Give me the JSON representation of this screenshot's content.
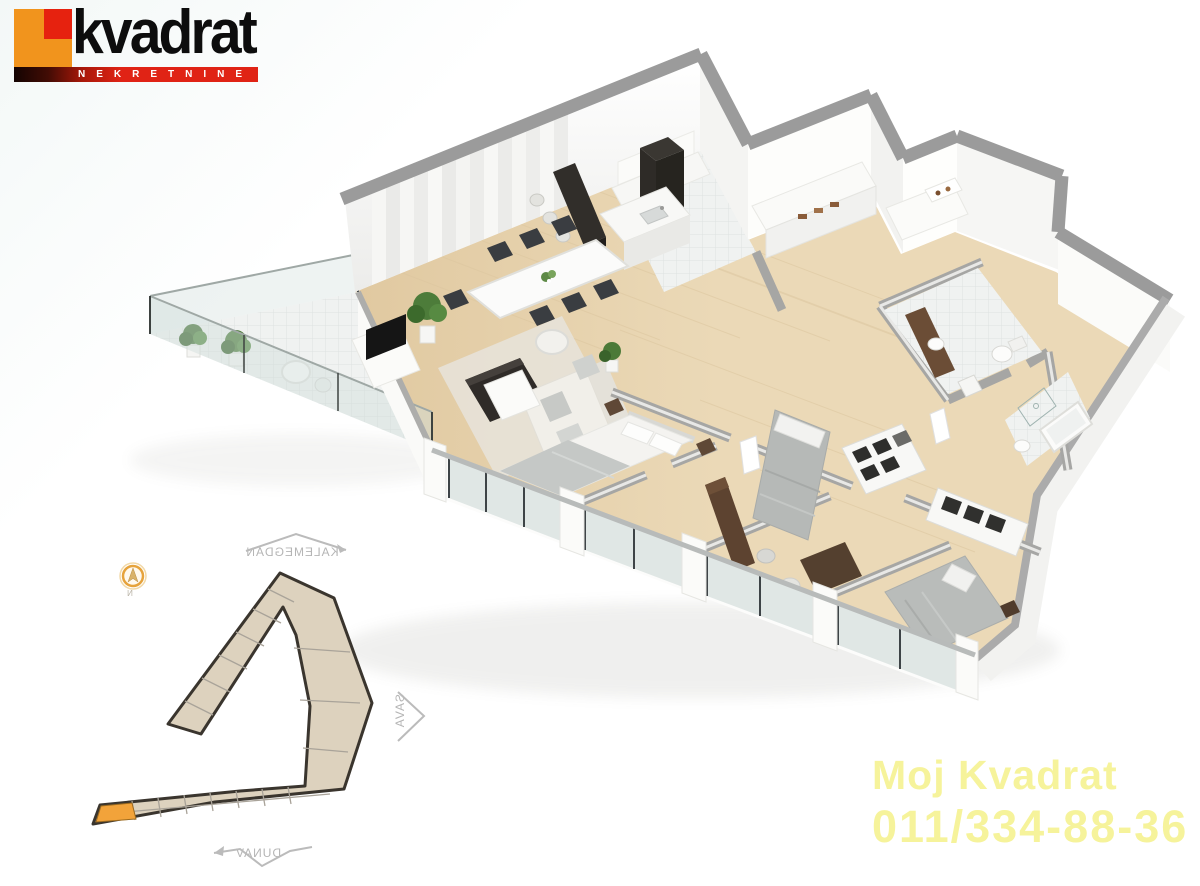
{
  "page": {
    "background": "#FFFFFF",
    "width": 1200,
    "height": 886
  },
  "logo": {
    "brand": "kvadrat",
    "tagline": "NEKRETNINE",
    "icon": "orange-red-square-logo",
    "colors": {
      "square_orange": "#F1941D",
      "square_red": "#E6220F",
      "bar_red": "#E02315",
      "bar_dark": "#140402",
      "brand_text": "#0D0D0D",
      "tagline_text": "#FFFFFF"
    }
  },
  "floor_plan": {
    "type": "3d-isometric-apartment-render",
    "rooms": [
      "terrace",
      "living-room",
      "dining-area",
      "kitchen",
      "hallway",
      "bathroom",
      "bathroom",
      "master-bedroom",
      "bedroom",
      "bedroom"
    ],
    "features": [
      "glass-balcony-railing",
      "potted-plants",
      "round-terrace-table",
      "dining-table-six-chairs",
      "kitchen-island-with-sink",
      "dark-bar-counter-with-stools",
      "tall-dark-cabinet",
      "sofa",
      "tv-unit",
      "coffee-table",
      "armchair",
      "rug",
      "double-beds",
      "nightstands",
      "wardrobes-with-clothes",
      "desks",
      "toilets",
      "bathtub",
      "vanity-with-sink",
      "window-wall-glass-facade"
    ],
    "palette": {
      "wood_floor": "#EBD9B7",
      "tile_floor": "#F0F2F1",
      "walls": "#FFFFFF",
      "wall_tops": "#9B9B9B",
      "dark_furniture": "#2F2B28",
      "wood_furniture": "#5F4836",
      "bedding_grey": "#C3C6C4",
      "plant_green": "#4C7A38",
      "glass": "#D8E1E0"
    }
  },
  "site_plan": {
    "description": "building-footprint-location-plan",
    "labels": {
      "top": {
        "text": "KALEMEGDAN",
        "mirrored": true
      },
      "right": {
        "text": "SAVA",
        "mirrored": true
      },
      "bottom": {
        "text": "DUNAV",
        "mirrored": true
      }
    },
    "compass": {
      "icon": "north-compass",
      "letter": "N"
    },
    "colors": {
      "building_fill": "#DDD2BE",
      "outline": "#3A352E",
      "unit_lines": "#A9A399",
      "unit_highlight": "#F2A33A",
      "label_text": "#B5B5B5",
      "compass_ring": "#E6A33C"
    }
  },
  "contact": {
    "line1": "Moj Kvadrat",
    "line2": "011/334-88-36",
    "color": "#F6F39B"
  }
}
